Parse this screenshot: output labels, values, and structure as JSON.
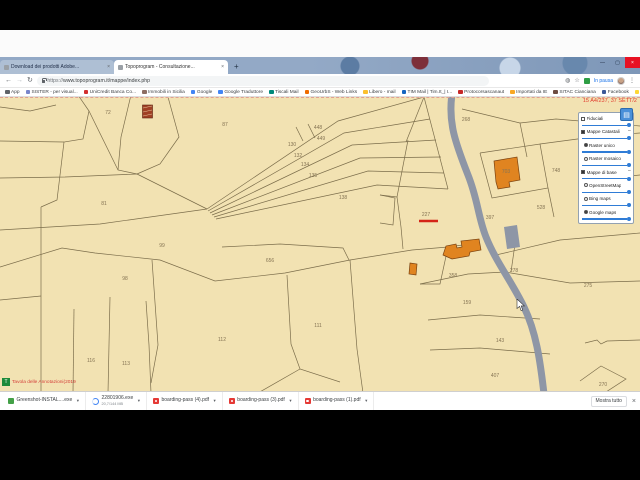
{
  "browser": {
    "tabs": [
      {
        "label": "Download dei prodotti Adobe...",
        "close": "×"
      },
      {
        "label": "Topoprogram - Consultazione...",
        "close": "×"
      }
    ],
    "new_tab": "+",
    "window_controls": {
      "minimize": "—",
      "maximize": "▢",
      "close": "×"
    },
    "url_scheme": "https://",
    "url_rest": "www.topoprogram.it/mappe/index.php",
    "profile_chip": "In pausa",
    "menu_dots": "⋮",
    "star": "☆",
    "back": "←",
    "forward": "→",
    "reload": "↻",
    "bookmarks": [
      {
        "label": "App",
        "color": "#5f6368"
      },
      {
        "label": "SISTER - per visual...",
        "color": "#7986cb"
      },
      {
        "label": "UniCredit Banca Co...",
        "color": "#d32f2f"
      },
      {
        "label": "Immobili in Sicilia",
        "color": "#8d6e63"
      },
      {
        "label": "Google",
        "color": "#4285f4"
      },
      {
        "label": "Google Traduttore",
        "color": "#4285f4"
      },
      {
        "label": "Tiscali Mail",
        "color": "#00897b"
      },
      {
        "label": "GeoUrbS - Web Links",
        "color": "#ef6c00"
      },
      {
        "label": "Libero - mail",
        "color": "#fbc02d"
      },
      {
        "label": "TIM Mail | Tim.It_| I...",
        "color": "#1565c0"
      },
      {
        "label": "Protocorsascanaut",
        "color": "#c62828"
      },
      {
        "label": "Importati da IE",
        "color": "#f9a825"
      },
      {
        "label": "SITAC Cianciana",
        "color": "#6d4c41"
      },
      {
        "label": "Facebook",
        "color": "#3b5998"
      },
      {
        "label": "Video Meteo Oggi -...",
        "color": "#fdd835"
      }
    ],
    "bookmarks_overflow": "»"
  },
  "map": {
    "coords_label": "15 A4/237, 37 SETT/2",
    "logo_letter": "T",
    "watermark": "Tavola delle Annotazioni(2019",
    "colors": {
      "background": "#f2e2b2",
      "parcel_line": "#6f6140",
      "road": "#8e96a6",
      "building": "#e08420",
      "annotation_red": "#d42417"
    },
    "parcels": [
      {
        "n": "72",
        "x": 108,
        "y": 16
      },
      {
        "n": "87",
        "x": 225,
        "y": 28
      },
      {
        "n": "448",
        "x": 318,
        "y": 31
      },
      {
        "n": "449",
        "x": 321,
        "y": 42
      },
      {
        "n": "130",
        "x": 292,
        "y": 48
      },
      {
        "n": "132",
        "x": 298,
        "y": 59
      },
      {
        "n": "134",
        "x": 305,
        "y": 68
      },
      {
        "n": "135",
        "x": 313,
        "y": 79
      },
      {
        "n": "138",
        "x": 343,
        "y": 101
      },
      {
        "n": "268",
        "x": 466,
        "y": 23
      },
      {
        "n": "81",
        "x": 104,
        "y": 107
      },
      {
        "n": "227",
        "x": 426,
        "y": 118
      },
      {
        "n": "397",
        "x": 490,
        "y": 121
      },
      {
        "n": "748",
        "x": 556,
        "y": 74
      },
      {
        "n": "528",
        "x": 541,
        "y": 111
      },
      {
        "n": "703",
        "x": 506,
        "y": 75
      },
      {
        "n": "99",
        "x": 162,
        "y": 149
      },
      {
        "n": "656",
        "x": 270,
        "y": 164
      },
      {
        "n": "98",
        "x": 125,
        "y": 182
      },
      {
        "n": "358",
        "x": 453,
        "y": 179
      },
      {
        "n": "278",
        "x": 514,
        "y": 174
      },
      {
        "n": "275",
        "x": 588,
        "y": 189
      },
      {
        "n": "159",
        "x": 467,
        "y": 206
      },
      {
        "n": "111",
        "x": 318,
        "y": 229
      },
      {
        "n": "112",
        "x": 222,
        "y": 243
      },
      {
        "n": "143",
        "x": 500,
        "y": 244
      },
      {
        "n": "116",
        "x": 91,
        "y": 264
      },
      {
        "n": "113",
        "x": 126,
        "y": 267
      },
      {
        "n": "407",
        "x": 495,
        "y": 279
      },
      {
        "n": "270",
        "x": 603,
        "y": 288
      }
    ]
  },
  "panel": {
    "toggle_glyph": "▤",
    "rows": [
      {
        "type": "layer",
        "control": "checkbox",
        "checked": false,
        "label": "Fiduciali",
        "expander": "+"
      },
      {
        "type": "slider"
      },
      {
        "type": "layer",
        "control": "checkbox",
        "checked": true,
        "label": "Mappe Catastali",
        "expander": "−"
      },
      {
        "type": "slider"
      },
      {
        "type": "layer",
        "control": "radio",
        "checked": true,
        "label": "Raster unico",
        "indent": true
      },
      {
        "type": "slider"
      },
      {
        "type": "layer",
        "control": "radio",
        "checked": false,
        "label": "Raster mosaico",
        "indent": true
      },
      {
        "type": "slider"
      },
      {
        "type": "layer",
        "control": "checkbox",
        "checked": true,
        "label": "Mappe di base",
        "expander": "−"
      },
      {
        "type": "slider"
      },
      {
        "type": "layer",
        "control": "radio",
        "checked": false,
        "label": "OpenStreetMap",
        "indent": true
      },
      {
        "type": "slider"
      },
      {
        "type": "layer",
        "control": "radio",
        "checked": false,
        "label": "Bing maps",
        "indent": true
      },
      {
        "type": "slider"
      },
      {
        "type": "layer",
        "control": "radio",
        "checked": true,
        "label": "Google maps",
        "indent": true
      },
      {
        "type": "slider"
      }
    ]
  },
  "downloads": {
    "items": [
      {
        "name": "Greenshot-INSTAL....exe",
        "icon": "greenshot"
      },
      {
        "name": "22801906.exe",
        "sub": "20,7/144 MB",
        "icon": "progress"
      },
      {
        "name": "boarding-pass (4).pdf",
        "icon": "pdf"
      },
      {
        "name": "boarding-pass (3).pdf",
        "icon": "pdf"
      },
      {
        "name": "boarding-pass (1).pdf",
        "icon": "pdf"
      }
    ],
    "show_all": "Mostra tutto",
    "close": "×"
  }
}
